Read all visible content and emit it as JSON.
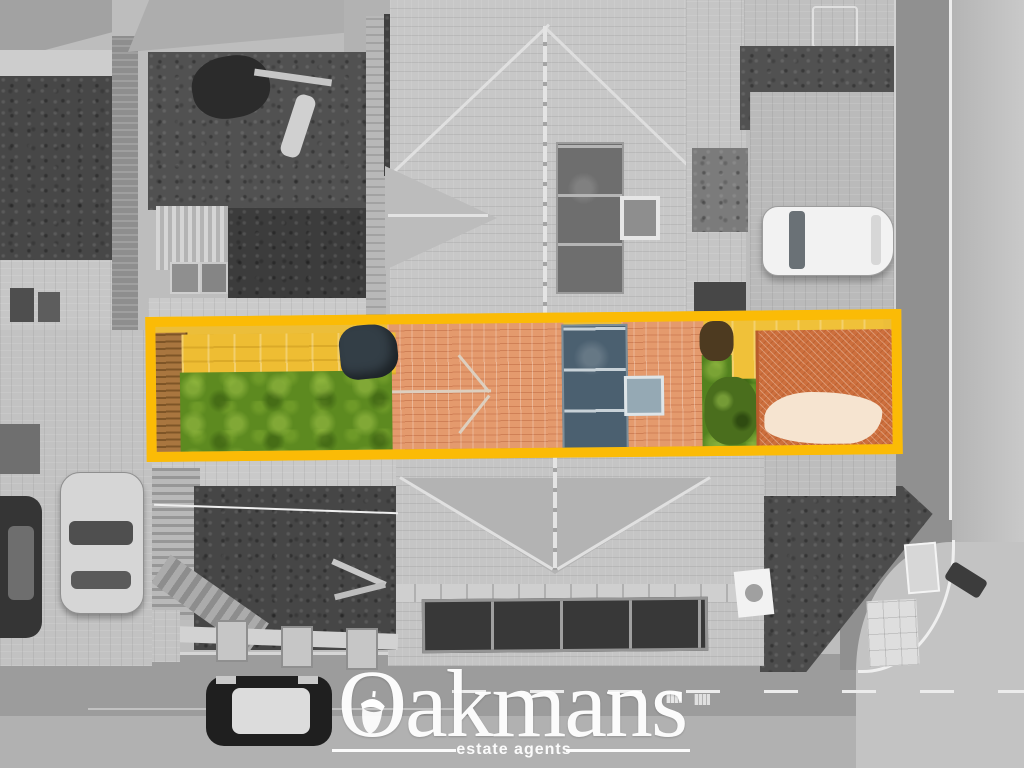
{
  "watermark": {
    "brand": "Oakmans",
    "tagline": "estate agents"
  },
  "highlight": {
    "type": "property-boundary-rectangle",
    "color": "#FBBB06"
  },
  "palette": {
    "highlight_yellow": "#FBBB06",
    "lawn_green": "#5D8A20",
    "patio_yellow": "#EEBD33",
    "roof_terracotta": "#E49A6D",
    "driveway_terracotta": "#CD6F3D",
    "solar_panel_slate": "#4B6070",
    "logo_white": "#FFFFFF",
    "surroundings": "grayscale"
  },
  "scene": {
    "objects": [
      "aerial-view-of-terraced-house",
      "highlighted-plot-boundary",
      "rear-garden-lawn",
      "timber-decking",
      "garden-tarp",
      "terracotta-roof-section",
      "roof-solar-panels",
      "roof-skylight",
      "block-paved-driveway",
      "neighbour-gardens",
      "garden-shed",
      "parked-cars",
      "roads-and-pavements",
      "estate-agent-watermark"
    ]
  }
}
